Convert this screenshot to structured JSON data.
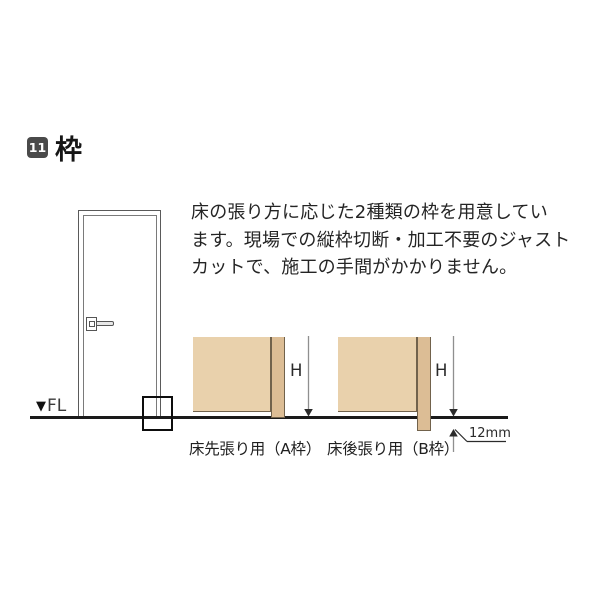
{
  "header": {
    "badge": "11",
    "title": "枠"
  },
  "description": {
    "lines": [
      "床の張り方に応じた2種類の枠を用意してい",
      "ます。現場での縦枠切断・加工不要のジャスト",
      "カットで、施工の手間がかかりません。"
    ]
  },
  "door_figure": {
    "floor_marker": "▼",
    "floor_label": "FL"
  },
  "diagrams": {
    "a": {
      "dim_label": "H",
      "caption": "床先張り用（A枠）"
    },
    "b": {
      "dim_label": "H",
      "caption": "床後張り用（B枠）",
      "offset_label": "12mm"
    }
  },
  "colors": {
    "badge_bg": "#4a4a4a",
    "text": "#242424",
    "wall_fill": "#e9d1ac",
    "frame_fill": "#dcbd95",
    "outline": "#71624c",
    "floor_line": "#1a1a1a",
    "dim_line": "#8f8f8f",
    "leader_line": "#2b2b2b"
  }
}
